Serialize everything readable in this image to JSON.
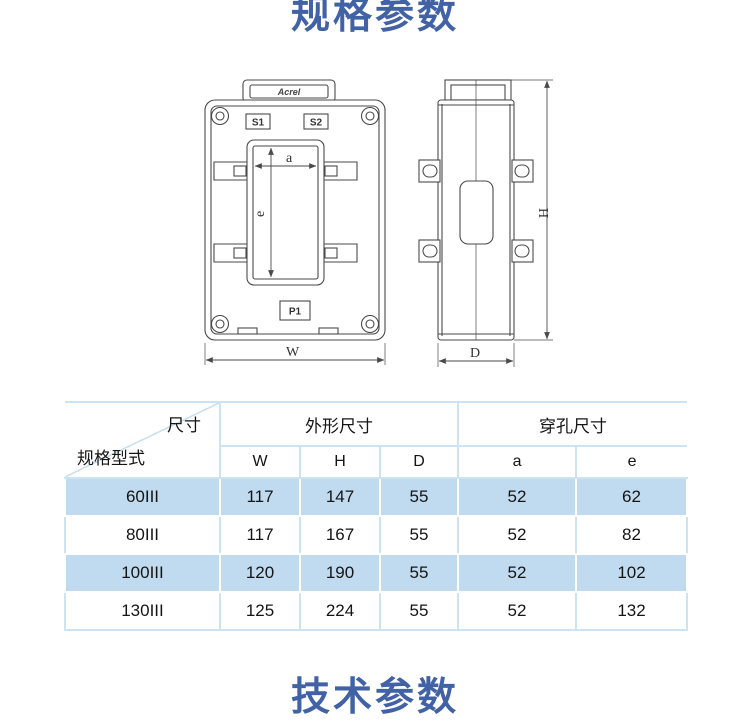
{
  "page": {
    "section_title_top": "规格参数",
    "section_title_bottom": "技术参数",
    "accent_color": "#4262A6",
    "table_alt_row_color": "#C0DAEF",
    "table_border_color": "#CCE3F2"
  },
  "diagram": {
    "brand_label": "Acrel",
    "front_view": {
      "terminal_top_left": "S1",
      "terminal_top_right": "S2",
      "terminal_bottom": "P1",
      "dim_hole_width": "a",
      "dim_hole_height": "e",
      "dim_overall_width": "W"
    },
    "side_view": {
      "dim_overall_height": "H",
      "dim_overall_depth": "D"
    }
  },
  "spec_table": {
    "corner": {
      "top_label": "尺寸",
      "bottom_label": "规格型式"
    },
    "column_groups": [
      {
        "label": "外形尺寸"
      },
      {
        "label": "穿孔尺寸"
      }
    ],
    "columns": [
      "W",
      "H",
      "D",
      "a",
      "e"
    ],
    "rows": [
      {
        "model": "60III",
        "values": [
          "117",
          "147",
          "55",
          "52",
          "62"
        ]
      },
      {
        "model": "80III",
        "values": [
          "117",
          "167",
          "55",
          "52",
          "82"
        ]
      },
      {
        "model": "100III",
        "values": [
          "120",
          "190",
          "55",
          "52",
          "102"
        ]
      },
      {
        "model": "130III",
        "values": [
          "125",
          "224",
          "55",
          "52",
          "132"
        ]
      }
    ]
  }
}
